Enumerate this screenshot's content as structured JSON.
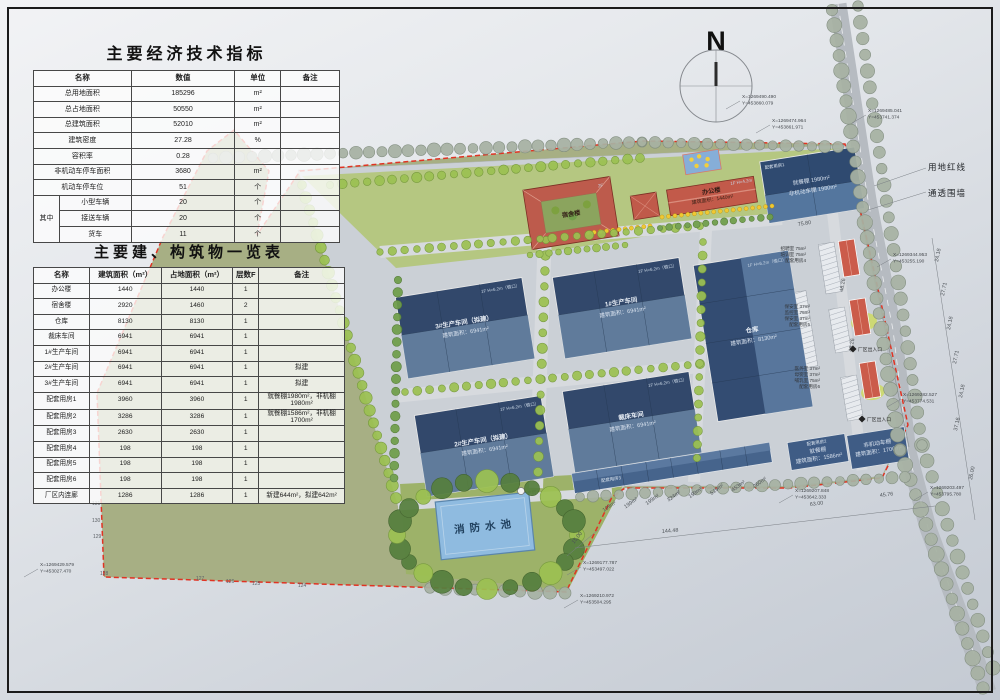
{
  "colors": {
    "red_line": "#e03323",
    "workshop_blue": "#32486b",
    "roof_red": "#c2584a",
    "pool_blue": "#8fbbe0",
    "parcel_green": "#a7af84",
    "road_gray": "#b6bbc1",
    "tree_bright": "#9cc152",
    "tree_sage": "#a7b2a3"
  },
  "north": {
    "label": "N"
  },
  "tables": {
    "indicators": {
      "title": "主要经济技术指标",
      "headers": [
        {
          "t": "名称",
          "cs": 2
        },
        "数值",
        "单位",
        "备注"
      ],
      "rows": [
        [
          {
            "t": "总用地面积",
            "cs": 2
          },
          "185296",
          "m²",
          ""
        ],
        [
          {
            "t": "总占地面积",
            "cs": 2
          },
          "50550",
          "m²",
          ""
        ],
        [
          {
            "t": "总建筑面积",
            "cs": 2
          },
          "52010",
          "m²",
          ""
        ],
        [
          {
            "t": "建筑密度",
            "cs": 2
          },
          "27.28",
          "%",
          ""
        ],
        [
          {
            "t": "容积率",
            "cs": 2
          },
          "0.28",
          "",
          ""
        ],
        [
          {
            "t": "非机动车停车面积",
            "cs": 2
          },
          "3680",
          "m²",
          ""
        ],
        [
          {
            "t": "机动车停车位",
            "cs": 2
          },
          "51",
          "个",
          ""
        ],
        [
          {
            "t": "其中",
            "rs": 3
          },
          "小型车辆",
          "20",
          "个",
          ""
        ],
        [
          "接送车辆",
          "20",
          "个",
          ""
        ],
        [
          "货车",
          "11",
          "个",
          ""
        ]
      ]
    },
    "buildings": {
      "title": "主要建、构筑物一览表",
      "headers": [
        "名称",
        "建筑面积（m²）",
        "占地面积（m²）",
        "层数F",
        "备注"
      ],
      "rows": [
        [
          "办公楼",
          "1440",
          "1440",
          "1",
          ""
        ],
        [
          "宿舍楼",
          "2920",
          "1460",
          "2",
          ""
        ],
        [
          "仓库",
          "8130",
          "8130",
          "1",
          ""
        ],
        [
          "裁床车间",
          "6941",
          "6941",
          "1",
          ""
        ],
        [
          "1#生产车间",
          "6941",
          "6941",
          "1",
          ""
        ],
        [
          "2#生产车间",
          "6941",
          "6941",
          "1",
          "拟建"
        ],
        [
          "3#生产车间",
          "6941",
          "6941",
          "1",
          "拟建"
        ],
        [
          "配套用房1",
          "3960",
          "3960",
          "1",
          "就餐棚1980m²，非机棚1980m²"
        ],
        [
          "配套用房2",
          "3286",
          "3286",
          "1",
          "就餐棚1586m²，非机棚1700m²"
        ],
        [
          "配套用房3",
          "2630",
          "2630",
          "1",
          ""
        ],
        [
          "配套用房4",
          "198",
          "198",
          "1",
          ""
        ],
        [
          "配套用房5",
          "198",
          "198",
          "1",
          ""
        ],
        [
          "配套用房6",
          "198",
          "198",
          "1",
          ""
        ],
        [
          "厂区内连廊",
          "1286",
          "1286",
          "1",
          "新建644m²，拟建642m²"
        ]
      ]
    }
  },
  "site": {
    "legend": {
      "red_line": "用地红线",
      "fence": "通透围墙"
    },
    "buildings": {
      "dorm": {
        "name": "宿舍楼",
        "floors": "2F"
      },
      "office": {
        "name": "办公楼",
        "area": "建筑面积：1440m²",
        "tag": "1F H=4.2m"
      },
      "w1": {
        "name": "1#生产车间",
        "area": "建筑面积：6941m²",
        "tag": "1F H=6.2m（檐口）"
      },
      "w2": {
        "name": "2#生产车间（拟建）",
        "area": "建筑面积：6941m²",
        "tag": "1F H=6.2m（檐口）"
      },
      "w3": {
        "name": "3#生产车间（拟建）",
        "area": "建筑面积：6941m²",
        "tag": "1F H=6.2m（檐口）"
      },
      "wc": {
        "name": "裁床车间",
        "area": "建筑面积：6941m²",
        "tag": "1F H=6.2m（檐口）"
      },
      "wh": {
        "name": "仓库",
        "area": "建筑面积：8130m²",
        "tag": "1F H=6.2m（檐口）"
      },
      "a1": {
        "tag": "配套用房1",
        "l1": "就餐棚 1980m²",
        "l2": "非机动车棚 1980m²"
      },
      "a2": {
        "tag": "配套用房2",
        "l1": "就餐棚",
        "l2": "建筑面积：1586m²"
      },
      "bike": {
        "l1": "非机动车棚",
        "l2": "建筑面积：1700m²"
      },
      "a3": {
        "tag": "配套用房3"
      },
      "pool": {
        "label": "消防水池"
      },
      "tower": {
        "label": "水塔"
      }
    },
    "annex3_areas": [
      "199m²",
      "199m²",
      "199m²",
      "324m²",
      "199m²",
      "519m²",
      "453m²",
      "260m²"
    ],
    "side_rooms": [
      [
        "招聘室 75m²",
        "培训室 75m²",
        "配套用房4"
      ],
      [
        "保安室 37m²",
        "监控室 75m²",
        "保安室 37m²",
        "配套用房5"
      ],
      [
        "医务室 37m²",
        "母婴室 37m²",
        "哺乳室 75m²",
        "配套用房6"
      ]
    ],
    "gates": [
      "厂区出入口",
      "厂区出入口"
    ],
    "coordinates": [
      {
        "t1": "X=1269490.490",
        "t2": "Y=453860.079",
        "x": 742,
        "y": 98
      },
      {
        "t1": "X=1269474.964",
        "t2": "Y=453861.971",
        "x": 772,
        "y": 122
      },
      {
        "t1": "X=1269485.041",
        "t2": "Y=453741.374",
        "x": 868,
        "y": 112
      },
      {
        "t1": "X=1269344.953",
        "t2": "Y=453255.190",
        "x": 893,
        "y": 256
      },
      {
        "t1": "X=1269282.527",
        "t2": "Y=453774.531",
        "x": 903,
        "y": 396
      },
      {
        "t1": "X=1269203.497",
        "t2": "Y=453795.780",
        "x": 930,
        "y": 489
      },
      {
        "t1": "X=1269207.848",
        "t2": "Y=453642.333",
        "x": 795,
        "y": 492
      },
      {
        "t1": "X=1269177.787",
        "t2": "Y=453497.022",
        "x": 583,
        "y": 564
      },
      {
        "t1": "X=1269210.972",
        "t2": "Y=453504.295",
        "x": 580,
        "y": 597
      },
      {
        "t1": "X=1269429.579",
        "t2": "Y=453027.470",
        "x": 40,
        "y": 566
      }
    ],
    "dimensions": [
      {
        "t": "144.48",
        "x": 662,
        "y": 533,
        "r": -5
      },
      {
        "t": "15.00",
        "x": 574,
        "y": 544,
        "r": -52
      },
      {
        "t": "63.00",
        "x": 810,
        "y": 506,
        "r": -7
      },
      {
        "t": "45.76",
        "x": 880,
        "y": 497,
        "r": -7
      },
      {
        "t": "37.16",
        "x": 957,
        "y": 431,
        "r": -78
      },
      {
        "t": "24.18",
        "x": 938,
        "y": 262,
        "r": -78
      },
      {
        "t": "27.71",
        "x": 944,
        "y": 296,
        "r": -78
      },
      {
        "t": "24.18",
        "x": 950,
        "y": 330,
        "r": -78
      },
      {
        "t": "27.71",
        "x": 956,
        "y": 364,
        "r": -78
      },
      {
        "t": "24.18",
        "x": 962,
        "y": 398,
        "r": -78
      },
      {
        "t": "26.00",
        "x": 972,
        "y": 480,
        "r": -78
      },
      {
        "t": "75.80",
        "x": 798,
        "y": 226,
        "r": -9
      },
      {
        "t": "48.26",
        "x": 843,
        "y": 292,
        "r": -80
      },
      {
        "t": "48.26",
        "x": 852,
        "y": 352,
        "r": -80
      }
    ],
    "elevations": [
      {
        "t": "131",
        "x": 92,
        "y": 505
      },
      {
        "t": "130",
        "x": 92,
        "y": 522
      },
      {
        "t": "129",
        "x": 93,
        "y": 538
      },
      {
        "t": "128",
        "x": 100,
        "y": 575
      },
      {
        "t": "127",
        "x": 196,
        "y": 580
      },
      {
        "t": "126",
        "x": 226,
        "y": 583
      },
      {
        "t": "125",
        "x": 252,
        "y": 585
      },
      {
        "t": "124",
        "x": 298,
        "y": 587
      }
    ]
  }
}
